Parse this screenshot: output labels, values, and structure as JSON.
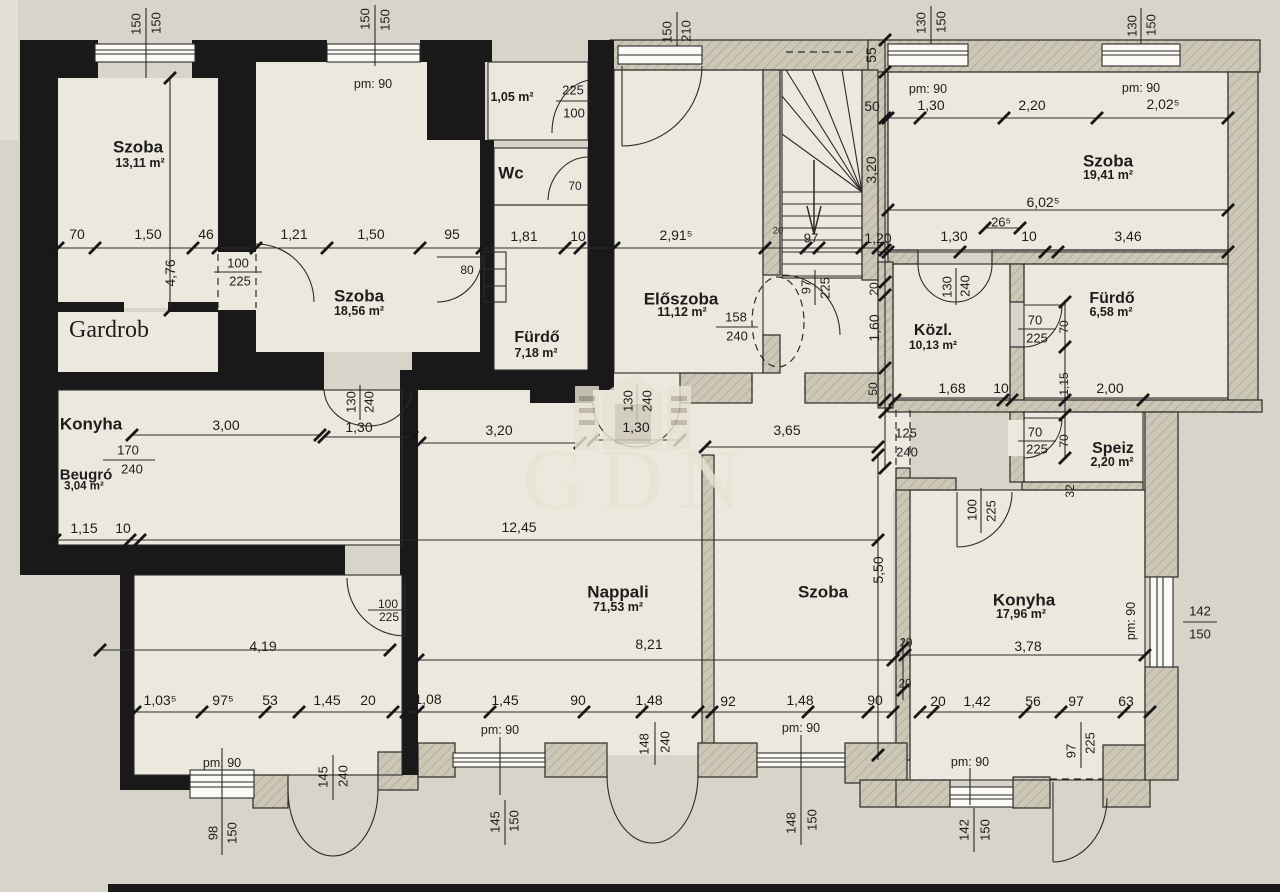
{
  "watermark": {
    "text": "GDN"
  },
  "colors": {
    "paper": "#d9d4c9",
    "room": "#ece8dd",
    "wall_black": "#191919",
    "wall_hatch": "#cdc7b7",
    "line": "#2b2b2b",
    "watermark": "#e7e2d4"
  },
  "labels": [
    {
      "t": "Szoba",
      "x": 138,
      "y": 147,
      "fs": 17,
      "b": 1,
      "n": "room-label"
    },
    {
      "t": "13,11 m²",
      "x": 140,
      "y": 163,
      "fs": 12.5,
      "b": 1,
      "n": "room-area-label"
    },
    {
      "t": "Szoba",
      "x": 359,
      "y": 296,
      "fs": 17,
      "b": 1,
      "n": "room-label"
    },
    {
      "t": "18,56 m²",
      "x": 359,
      "y": 311,
      "fs": 12.5,
      "b": 1,
      "n": "room-area-label"
    },
    {
      "t": "Wc",
      "x": 511,
      "y": 173,
      "fs": 17,
      "b": 1,
      "n": "room-label"
    },
    {
      "t": "Fürdő",
      "x": 537,
      "y": 338,
      "fs": 16,
      "b": 1,
      "n": "room-label"
    },
    {
      "t": "7,18 m²",
      "x": 536,
      "y": 353,
      "fs": 12.5,
      "b": 1,
      "n": "room-area-label"
    },
    {
      "t": "Előszoba",
      "x": 681,
      "y": 299,
      "fs": 17,
      "b": 1,
      "n": "room-label"
    },
    {
      "t": "11,12 m²",
      "x": 682,
      "y": 312,
      "fs": 12.5,
      "b": 1,
      "n": "room-area-label"
    },
    {
      "t": "Szoba",
      "x": 1108,
      "y": 161,
      "fs": 17,
      "b": 1,
      "n": "room-label"
    },
    {
      "t": "19,41 m²",
      "x": 1108,
      "y": 175,
      "fs": 12.5,
      "b": 1,
      "n": "room-area-label"
    },
    {
      "t": "Közl.",
      "x": 933,
      "y": 331,
      "fs": 16,
      "b": 1,
      "n": "room-label"
    },
    {
      "t": "10,13 m²",
      "x": 933,
      "y": 345,
      "fs": 12,
      "b": 1,
      "n": "room-area-label"
    },
    {
      "t": "Fürdő",
      "x": 1112,
      "y": 299,
      "fs": 16,
      "b": 1,
      "n": "room-label"
    },
    {
      "t": "6,58 m²",
      "x": 1111,
      "y": 312,
      "fs": 12.5,
      "b": 1,
      "n": "room-area-label"
    },
    {
      "t": "Gardrob",
      "x": 109,
      "y": 330,
      "fs": 24,
      "sf": 1,
      "n": "room-label"
    },
    {
      "t": "Konyha",
      "x": 91,
      "y": 424,
      "fs": 17,
      "b": 1,
      "n": "room-label"
    },
    {
      "t": "Beugró",
      "x": 86,
      "y": 475,
      "fs": 15,
      "b": 1,
      "n": "room-label"
    },
    {
      "t": "3,04 m²",
      "x": 84,
      "y": 487,
      "fs": 11.5,
      "b": 1,
      "n": "room-area-label"
    },
    {
      "t": "Speiz",
      "x": 1113,
      "y": 449,
      "fs": 16,
      "b": 1,
      "n": "room-label"
    },
    {
      "t": "2,20 m²",
      "x": 1112,
      "y": 462,
      "fs": 12.5,
      "b": 1,
      "n": "room-area-label"
    },
    {
      "t": "Nappali",
      "x": 618,
      "y": 592,
      "fs": 17,
      "b": 1,
      "n": "room-label"
    },
    {
      "t": "71,53 m²",
      "x": 618,
      "y": 607,
      "fs": 12.5,
      "b": 1,
      "n": "room-area-label"
    },
    {
      "t": "Szoba",
      "x": 823,
      "y": 592,
      "fs": 17,
      "b": 1,
      "n": "room-label"
    },
    {
      "t": "Konyha",
      "x": 1024,
      "y": 600,
      "fs": 17,
      "b": 1,
      "n": "room-label"
    },
    {
      "t": "17,96 m²",
      "x": 1021,
      "y": 614,
      "fs": 12.5,
      "b": 1,
      "n": "room-area-label"
    },
    {
      "t": "1,05 m²",
      "x": 512,
      "y": 97,
      "fs": 12.5,
      "b": 1,
      "n": "room-area-label"
    },
    {
      "t": "pm: 90",
      "x": 373,
      "y": 84,
      "fs": 12.5,
      "n": "height-label"
    },
    {
      "t": "pm: 90",
      "x": 928,
      "y": 89,
      "fs": 12.5,
      "n": "height-label"
    },
    {
      "t": "pm: 90",
      "x": 1141,
      "y": 88,
      "fs": 12.5,
      "n": "height-label"
    },
    {
      "t": "pm: 90",
      "x": 222,
      "y": 763,
      "fs": 12.5,
      "n": "height-label"
    },
    {
      "t": "pm: 90",
      "x": 500,
      "y": 730,
      "fs": 12.5,
      "n": "height-label"
    },
    {
      "t": "pm: 90",
      "x": 801,
      "y": 728,
      "fs": 12.5,
      "n": "height-label"
    },
    {
      "t": "pm: 90",
      "x": 970,
      "y": 762,
      "fs": 12.5,
      "n": "height-label"
    },
    {
      "t": "pm: 90",
      "x": 1131,
      "y": 621,
      "fs": 12.5,
      "r": -90,
      "n": "height-label"
    },
    {
      "t": "70",
      "x": 77,
      "y": 234
    },
    {
      "t": "1,50",
      "x": 148,
      "y": 234
    },
    {
      "t": "46",
      "x": 206,
      "y": 234
    },
    {
      "t": "50",
      "x": 236,
      "y": 234
    },
    {
      "t": "1,21",
      "x": 294,
      "y": 234
    },
    {
      "t": "1,50",
      "x": 371,
      "y": 234
    },
    {
      "t": "95",
      "x": 452,
      "y": 234
    },
    {
      "t": "1,81",
      "x": 524,
      "y": 236
    },
    {
      "t": "10",
      "x": 578,
      "y": 236
    },
    {
      "t": "2,91⁵",
      "x": 676,
      "y": 235
    },
    {
      "t": "20",
      "x": 778,
      "y": 231,
      "fs": 9.5
    },
    {
      "t": "97",
      "x": 811,
      "y": 238,
      "fs": 13
    },
    {
      "t": "1,20",
      "x": 878,
      "y": 238
    },
    {
      "t": "1,30",
      "x": 954,
      "y": 236
    },
    {
      "t": "26⁵",
      "x": 1001,
      "y": 222,
      "fs": 13
    },
    {
      "t": "10",
      "x": 1029,
      "y": 236
    },
    {
      "t": "3,46",
      "x": 1128,
      "y": 236
    },
    {
      "t": "50",
      "x": 872,
      "y": 106
    },
    {
      "t": "1,30",
      "x": 931,
      "y": 105
    },
    {
      "t": "2,20",
      "x": 1032,
      "y": 105
    },
    {
      "t": "2,02⁵",
      "x": 1163,
      "y": 104
    },
    {
      "t": "6,02⁵",
      "x": 1043,
      "y": 202
    },
    {
      "t": "4,76",
      "x": 170,
      "y": 273,
      "r": -90
    },
    {
      "t": "55",
      "x": 871,
      "y": 55,
      "r": -90
    },
    {
      "t": "3,20",
      "x": 871,
      "y": 170,
      "r": -90
    },
    {
      "t": "20",
      "x": 874,
      "y": 289,
      "fs": 12,
      "r": -90
    },
    {
      "t": "1,60",
      "x": 874,
      "y": 328,
      "r": -90
    },
    {
      "t": "50",
      "x": 873,
      "y": 389,
      "fs": 12,
      "r": -90
    },
    {
      "t": "5,50",
      "x": 878,
      "y": 570,
      "r": -90
    },
    {
      "t": "70",
      "x": 1064,
      "y": 327,
      "fs": 12,
      "r": -90
    },
    {
      "t": "1,15",
      "x": 1064,
      "y": 384,
      "fs": 12,
      "r": -90
    },
    {
      "t": "70",
      "x": 1064,
      "y": 441,
      "fs": 12,
      "r": -90
    },
    {
      "t": "32",
      "x": 1070,
      "y": 491,
      "fs": 12,
      "r": -90
    },
    {
      "t": "20",
      "x": 906,
      "y": 644,
      "fs": 11.5
    },
    {
      "t": "20",
      "x": 905,
      "y": 685,
      "fs": 11.5
    },
    {
      "t": "3,00",
      "x": 226,
      "y": 425
    },
    {
      "t": "1,30",
      "x": 359,
      "y": 427
    },
    {
      "t": "3,20",
      "x": 499,
      "y": 430
    },
    {
      "t": "1,30",
      "x": 636,
      "y": 427
    },
    {
      "t": "3,65",
      "x": 787,
      "y": 430
    },
    {
      "t": "1,68",
      "x": 952,
      "y": 388
    },
    {
      "t": "10",
      "x": 1001,
      "y": 388
    },
    {
      "t": "2,00",
      "x": 1110,
      "y": 388
    },
    {
      "t": "1,15",
      "x": 84,
      "y": 528
    },
    {
      "t": "10",
      "x": 123,
      "y": 528
    },
    {
      "t": "12,45",
      "x": 519,
      "y": 527
    },
    {
      "t": "4,19",
      "x": 263,
      "y": 646
    },
    {
      "t": "8,21",
      "x": 649,
      "y": 644
    },
    {
      "t": "3,78",
      "x": 1028,
      "y": 646
    },
    {
      "t": "1,03⁵",
      "x": 160,
      "y": 700
    },
    {
      "t": "97⁵",
      "x": 223,
      "y": 700
    },
    {
      "t": "53",
      "x": 270,
      "y": 700
    },
    {
      "t": "1,45",
      "x": 327,
      "y": 700
    },
    {
      "t": "20",
      "x": 368,
      "y": 700
    },
    {
      "t": "1,08",
      "x": 428,
      "y": 699
    },
    {
      "t": "1,45",
      "x": 505,
      "y": 700
    },
    {
      "t": "90",
      "x": 578,
      "y": 700
    },
    {
      "t": "1,48",
      "x": 649,
      "y": 700
    },
    {
      "t": "92",
      "x": 728,
      "y": 701
    },
    {
      "t": "1,48",
      "x": 800,
      "y": 700
    },
    {
      "t": "90",
      "x": 875,
      "y": 700
    },
    {
      "t": "20",
      "x": 938,
      "y": 701
    },
    {
      "t": "1,42",
      "x": 977,
      "y": 701
    },
    {
      "t": "56",
      "x": 1033,
      "y": 701
    },
    {
      "t": "97",
      "x": 1076,
      "y": 701
    },
    {
      "t": "63",
      "x": 1126,
      "y": 701
    },
    {
      "t": "150",
      "x": 136,
      "y": 24,
      "fs": 13,
      "r": -90,
      "n": "opening-label"
    },
    {
      "t": "150",
      "x": 156,
      "y": 23,
      "fs": 13,
      "r": -90,
      "n": "opening-label"
    },
    {
      "t": "150",
      "x": 365,
      "y": 19,
      "fs": 13,
      "r": -90,
      "n": "opening-label"
    },
    {
      "t": "150",
      "x": 385,
      "y": 20,
      "fs": 13,
      "r": -90,
      "n": "opening-label"
    },
    {
      "t": "225",
      "x": 573,
      "y": 90,
      "fs": 13,
      "n": "opening-label"
    },
    {
      "t": "100",
      "x": 574,
      "y": 113,
      "fs": 13,
      "n": "opening-label"
    },
    {
      "t": "70",
      "x": 575,
      "y": 186,
      "fs": 12,
      "n": "opening-label"
    },
    {
      "t": "150",
      "x": 667,
      "y": 32,
      "fs": 13,
      "r": -90,
      "n": "opening-label"
    },
    {
      "t": "210",
      "x": 686,
      "y": 31,
      "fs": 13,
      "r": -90,
      "n": "opening-label"
    },
    {
      "t": "130",
      "x": 921,
      "y": 23,
      "fs": 13,
      "r": -90,
      "n": "opening-label"
    },
    {
      "t": "150",
      "x": 941,
      "y": 22,
      "fs": 13,
      "r": -90,
      "n": "opening-label"
    },
    {
      "t": "130",
      "x": 1132,
      "y": 26,
      "fs": 13,
      "r": -90,
      "n": "opening-label"
    },
    {
      "t": "150",
      "x": 1151,
      "y": 25,
      "fs": 13,
      "r": -90,
      "n": "opening-label"
    },
    {
      "t": "100",
      "x": 238,
      "y": 263,
      "fs": 13,
      "n": "opening-label"
    },
    {
      "t": "225",
      "x": 240,
      "y": 281,
      "fs": 13,
      "n": "opening-label"
    },
    {
      "t": "80",
      "x": 467,
      "y": 270,
      "fs": 12,
      "n": "opening-label"
    },
    {
      "t": "130",
      "x": 351,
      "y": 402,
      "fs": 13,
      "r": -90,
      "n": "opening-label"
    },
    {
      "t": "240",
      "x": 369,
      "y": 402,
      "fs": 13,
      "r": -90,
      "n": "opening-label"
    },
    {
      "t": "130",
      "x": 628,
      "y": 401,
      "fs": 13,
      "r": -90,
      "n": "opening-label"
    },
    {
      "t": "240",
      "x": 647,
      "y": 401,
      "fs": 13,
      "r": -90,
      "n": "opening-label"
    },
    {
      "t": "158",
      "x": 736,
      "y": 317,
      "fs": 13,
      "n": "opening-label"
    },
    {
      "t": "240",
      "x": 737,
      "y": 336,
      "fs": 13,
      "n": "opening-label"
    },
    {
      "t": "97",
      "x": 806,
      "y": 287,
      "fs": 13,
      "r": -90,
      "n": "opening-label"
    },
    {
      "t": "225",
      "x": 825,
      "y": 288,
      "fs": 13,
      "r": -90,
      "n": "opening-label"
    },
    {
      "t": "130",
      "x": 947,
      "y": 287,
      "fs": 13,
      "r": -90,
      "n": "opening-label"
    },
    {
      "t": "240",
      "x": 965,
      "y": 286,
      "fs": 13,
      "r": -90,
      "n": "opening-label"
    },
    {
      "t": "70",
      "x": 1035,
      "y": 320,
      "fs": 13,
      "n": "opening-label"
    },
    {
      "t": "225",
      "x": 1037,
      "y": 338,
      "fs": 13,
      "n": "opening-label"
    },
    {
      "t": "70",
      "x": 1035,
      "y": 432,
      "fs": 13,
      "n": "opening-label"
    },
    {
      "t": "225",
      "x": 1037,
      "y": 449,
      "fs": 13,
      "n": "opening-label"
    },
    {
      "t": "100",
      "x": 972,
      "y": 510,
      "fs": 13,
      "r": -90,
      "n": "opening-label"
    },
    {
      "t": "225",
      "x": 991,
      "y": 511,
      "fs": 13,
      "r": -90,
      "n": "opening-label"
    },
    {
      "t": "125",
      "x": 906,
      "y": 433,
      "fs": 13,
      "n": "opening-label"
    },
    {
      "t": "240",
      "x": 907,
      "y": 452,
      "fs": 13,
      "n": "opening-label"
    },
    {
      "t": "170",
      "x": 128,
      "y": 450,
      "fs": 13,
      "n": "opening-label"
    },
    {
      "t": "240",
      "x": 132,
      "y": 469,
      "fs": 13,
      "n": "opening-label"
    },
    {
      "t": "100",
      "x": 388,
      "y": 604,
      "fs": 12,
      "n": "opening-label"
    },
    {
      "t": "225",
      "x": 389,
      "y": 617,
      "fs": 12,
      "n": "opening-label"
    },
    {
      "t": "145",
      "x": 323,
      "y": 777,
      "fs": 13,
      "r": -90,
      "n": "opening-label"
    },
    {
      "t": "240",
      "x": 343,
      "y": 776,
      "fs": 13,
      "r": -90,
      "n": "opening-label"
    },
    {
      "t": "98",
      "x": 213,
      "y": 833,
      "fs": 13,
      "r": -90,
      "n": "opening-label"
    },
    {
      "t": "150",
      "x": 232,
      "y": 833,
      "fs": 13,
      "r": -90,
      "n": "opening-label"
    },
    {
      "t": "145",
      "x": 495,
      "y": 822,
      "fs": 13,
      "r": -90,
      "n": "opening-label"
    },
    {
      "t": "150",
      "x": 514,
      "y": 821,
      "fs": 13,
      "r": -90,
      "n": "opening-label"
    },
    {
      "t": "148",
      "x": 644,
      "y": 744,
      "fs": 13,
      "r": -90,
      "n": "opening-label"
    },
    {
      "t": "240",
      "x": 665,
      "y": 742,
      "fs": 13,
      "r": -90,
      "n": "opening-label"
    },
    {
      "t": "148",
      "x": 791,
      "y": 823,
      "fs": 13,
      "r": -90,
      "n": "opening-label"
    },
    {
      "t": "150",
      "x": 812,
      "y": 820,
      "fs": 13,
      "r": -90,
      "n": "opening-label"
    },
    {
      "t": "142",
      "x": 964,
      "y": 830,
      "fs": 13,
      "r": -90,
      "n": "opening-label"
    },
    {
      "t": "150",
      "x": 985,
      "y": 830,
      "fs": 13,
      "r": -90,
      "n": "opening-label"
    },
    {
      "t": "97",
      "x": 1071,
      "y": 751,
      "fs": 13,
      "r": -90,
      "n": "opening-label"
    },
    {
      "t": "225",
      "x": 1090,
      "y": 743,
      "fs": 13,
      "r": -90,
      "n": "opening-label"
    },
    {
      "t": "142",
      "x": 1200,
      "y": 611,
      "fs": 13,
      "n": "opening-label"
    },
    {
      "t": "150",
      "x": 1200,
      "y": 634,
      "fs": 13,
      "n": "opening-label"
    }
  ]
}
